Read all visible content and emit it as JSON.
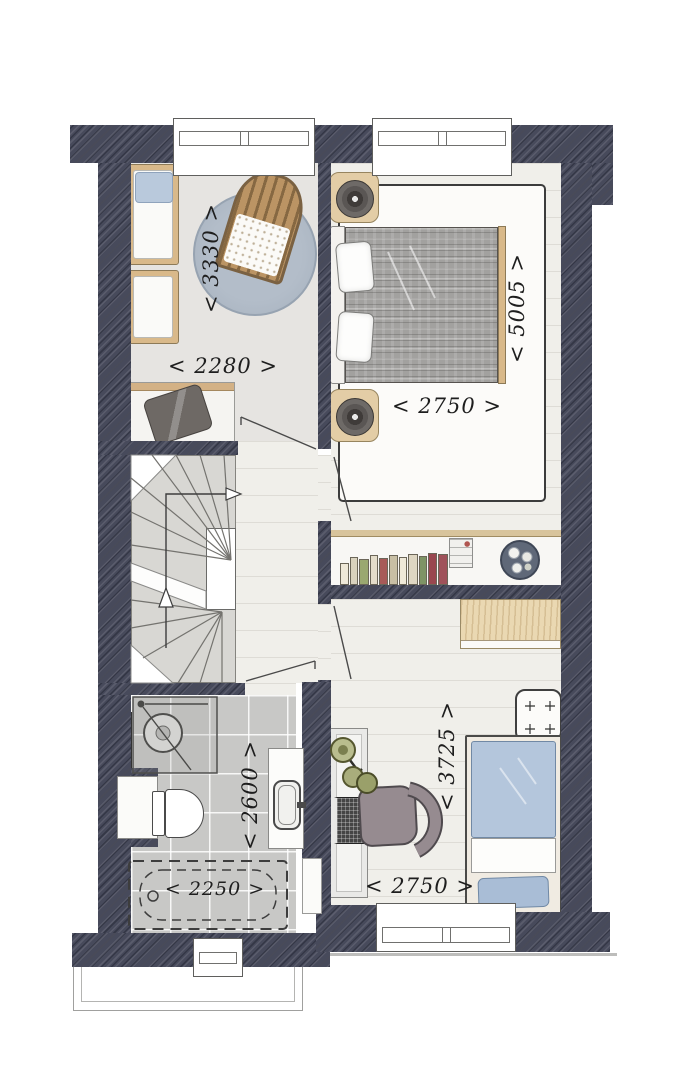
{
  "drawing_type": "residential floor plan (upper storey)",
  "rooms": {
    "nursery": {
      "depth_label": "< 3330 >",
      "width_label": "< 2280 >"
    },
    "master_bedroom": {
      "depth_label": "< 5005 >",
      "width_label": "< 2750 >"
    },
    "bathroom": {
      "depth_label": "< 2600 >",
      "tub_label": "< 2250 >"
    },
    "bedroom3": {
      "depth_label": "< 3725 >",
      "width_label": "< 2750 >"
    }
  },
  "colors": {
    "wall": "#474a5b",
    "plank_floor": "#f0efea",
    "tile_floor": "#c8c8c6",
    "nursery_floor": "#e6e4e1",
    "stair_floor": "#d8d7d3",
    "accent_wood": "#d9b98a",
    "rug_blue": "#a9b4c1",
    "duvet_grey": "#a2a19f",
    "duvet_blue": "#b4c6dc"
  }
}
